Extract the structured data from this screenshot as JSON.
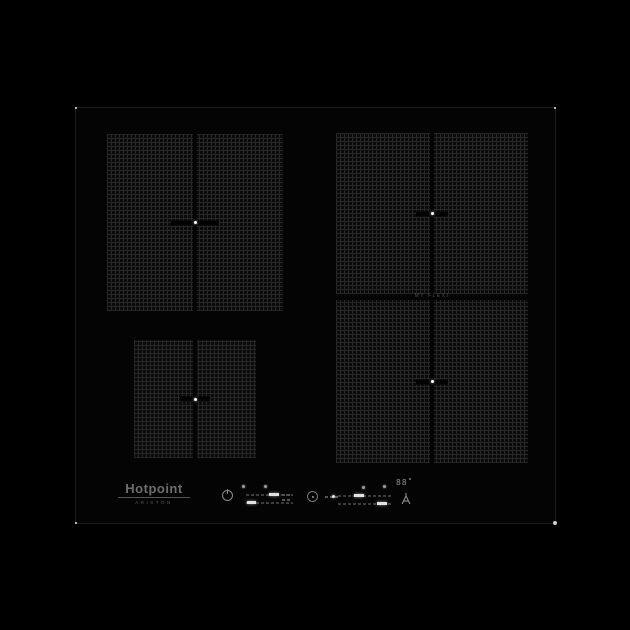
{
  "product": {
    "brand": "Hotpoint",
    "sub_brand": "ARISTON",
    "type": "induction-hob-product-photo"
  },
  "labels": {
    "flexi_zone": "MY FLEXI"
  },
  "zones": [
    {
      "id": "rear-left",
      "description": "large square flexi zone, two bridgeable halves, center cross marker"
    },
    {
      "id": "front-left",
      "description": "small square flexi zone, two bridgeable halves, center cross marker"
    },
    {
      "id": "rear-right",
      "description": "large square flexi zone, upper half of right flexi area"
    },
    {
      "id": "front-right",
      "description": "large square flexi zone, lower half of right flexi area"
    }
  ],
  "control_panel": {
    "display_value": "88",
    "icons": [
      {
        "name": "power-icon",
        "glyph": "circle-with-bar"
      },
      {
        "name": "clock-icon",
        "glyph": "dial-circle"
      },
      {
        "name": "lock-icon",
        "glyph": "A-shape"
      },
      {
        "name": "indicator-led",
        "glyph": "small-dot"
      }
    ],
    "sliders": [
      {
        "name": "slider-rear-left",
        "level_segment": "mid"
      },
      {
        "name": "slider-front-left",
        "level_segment": "low"
      },
      {
        "name": "slider-rear-right",
        "level_segment": "low-mid"
      },
      {
        "name": "slider-front-right",
        "level_segment": "high-mid"
      }
    ]
  },
  "colors": {
    "background": "#000000",
    "glass": "#040404",
    "zone_grid": "#272727",
    "edge_line": "#1b1b1b",
    "logo_gray": "#6e6e6e",
    "control_gray": "#8a8a8a",
    "active_segment": "#e2e2e2"
  }
}
